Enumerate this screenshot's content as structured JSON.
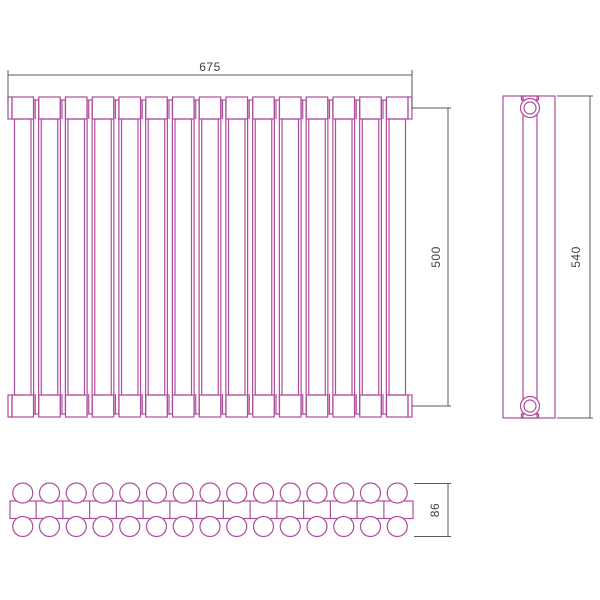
{
  "page": {
    "background": "#ffffff"
  },
  "drawing": {
    "type": "technical-drawing",
    "subject": "tubular radiator — front, side and top orthographic views",
    "colors": {
      "outline": "#ad4c9d",
      "dimension_line": "#5a5a5a",
      "text": "#3f3f3f",
      "fill": "#ffffff"
    },
    "front_view": {
      "sections": 15
    },
    "side_view": {
      "connections": 2
    },
    "plan_view": {
      "rows": 2,
      "tubes_per_row": 15
    },
    "dimensions": {
      "width": {
        "label": "675"
      },
      "axis_height": {
        "label": "500"
      },
      "overall_height": {
        "label": "540"
      },
      "depth": {
        "label": "86"
      }
    }
  }
}
